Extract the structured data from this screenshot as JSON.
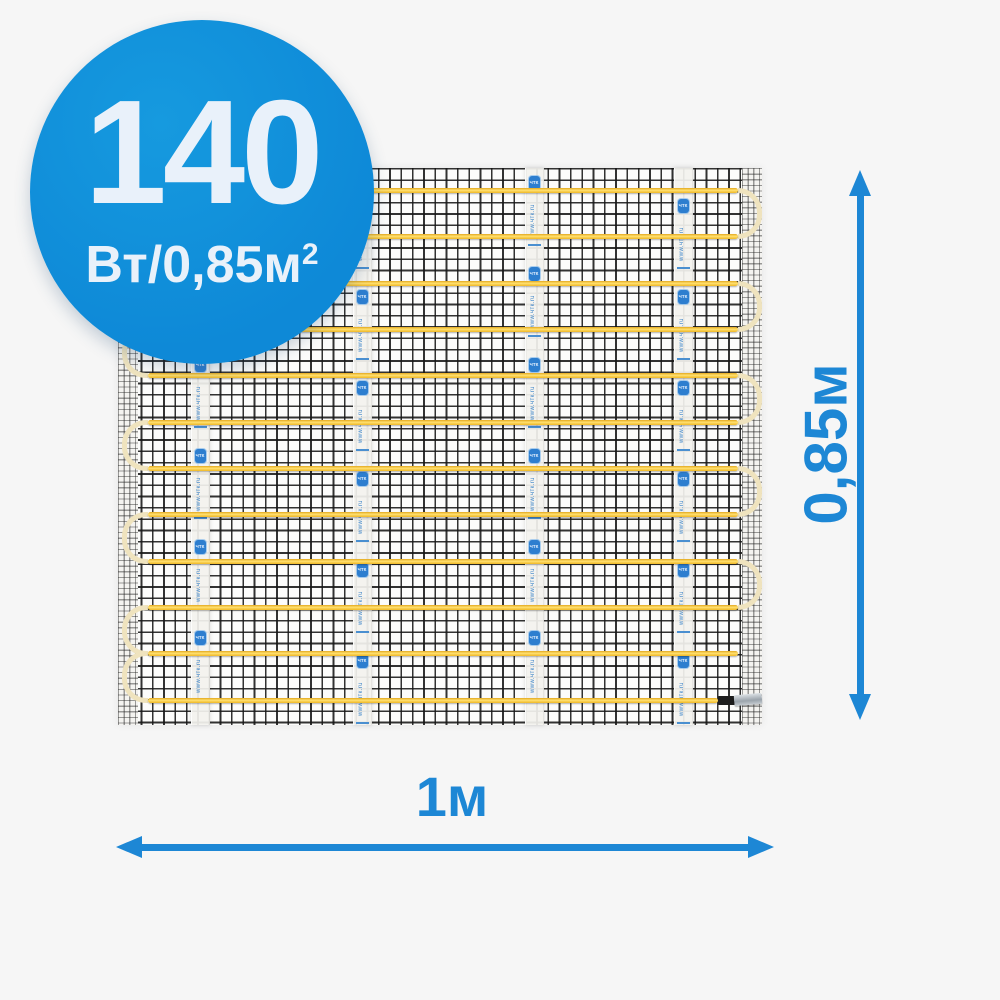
{
  "colors": {
    "page_background": "#f6f6f6",
    "accent_blue": "#1d87d5",
    "badge_blue": "#0e89d7",
    "badge_text": "#e9f1fa",
    "cable_yellow": "#f7c52e",
    "loop_cream": "#efe3be",
    "tape_blue": "#3f86c9"
  },
  "badge": {
    "power_value": "140",
    "power_unit": "Вт/0,85м",
    "power_unit_sup": "2"
  },
  "dimensions": {
    "height_label": "0,85м",
    "width_label": "1м"
  },
  "mat": {
    "tape_text": "www.чтк.ru",
    "tape_stamp_icon": "ЧТК",
    "cable_rel_y": [
      20,
      66,
      113,
      159,
      205,
      252,
      298,
      344,
      391,
      437,
      483,
      530
    ],
    "right_loop_pairs": [
      [
        0,
        1
      ],
      [
        2,
        3
      ],
      [
        4,
        5
      ],
      [
        6,
        7
      ],
      [
        8,
        9
      ]
    ],
    "left_loop_pairs": [
      [
        1,
        2
      ],
      [
        3,
        4
      ],
      [
        5,
        6
      ],
      [
        7,
        8
      ],
      [
        9,
        10
      ],
      [
        10,
        11
      ]
    ],
    "tape_rel_x_centers": [
      82,
      244,
      416,
      565
    ],
    "run_start_x": 30,
    "run_width": 590,
    "last_run_width": 570
  }
}
